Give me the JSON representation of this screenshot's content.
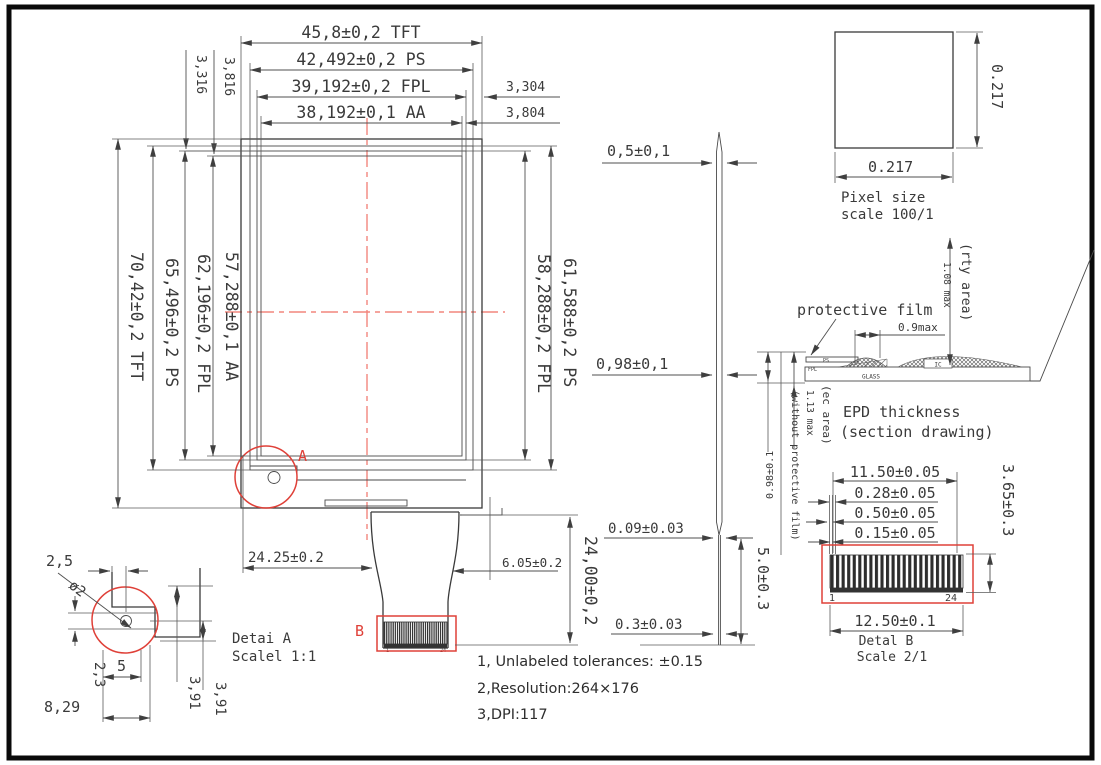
{
  "colors": {
    "line": "#3a3a3a",
    "dim_line": "#4f4f4f",
    "accent_red": "#df4038",
    "centerline_red": "#f2857d"
  },
  "front_view": {
    "top_dims": {
      "tft": "45,8±0,2 TFT",
      "ps": "42,492±0,2 PS",
      "fpl": "39,192±0,2 FPL",
      "aa": "38,192±0,1 AA",
      "right_offset_fpl": "3,304",
      "right_offset_aa": "3,804",
      "left_offset_fpl": "3,316",
      "left_offset_aa": "3,816"
    },
    "left_dims": {
      "tft": "70,42±0,2 TFT",
      "ps": "65,496±0,2 PS",
      "fpl": "62,196±0,2 FPL",
      "aa": "57,288±0,1 AA"
    },
    "right_dims": {
      "ps": "61,588±0,2 PS",
      "fpl": "58,288±0,2 FPL"
    },
    "bottom_dims": {
      "tail_offset": "24.25±0.2",
      "tail_side": "6.05±0.2",
      "tail_length": "24,00±0,2"
    },
    "detail_a_marker": "A",
    "detail_b_marker": "B"
  },
  "side_view": {
    "top": "0,5±0,1",
    "mid": "0,98±0,1",
    "fpc": "0.09±0.03",
    "stiffener": "5.0±0.3",
    "bottom": "0.3±0.03"
  },
  "pixel_view": {
    "width": "0.217",
    "height": "0.217",
    "caption1": "Pixel size",
    "caption2": "scale 100/1"
  },
  "section_view": {
    "film_label": "protective film",
    "dim_ic": "0.9max",
    "rty_area": "(rty area)",
    "rty_max": "1.08 max",
    "ec_area": "(ec area)",
    "ec_max": "1.13 max",
    "without_film": "(without protective film)",
    "without_dim": "0.98±0.1",
    "ps": "PS",
    "fpl": "FPL",
    "ic": "IC",
    "glass": "GLASS",
    "caption1": "EPD thickness",
    "caption2": "(section drawing)"
  },
  "detail_b": {
    "pitch_total": "11.50±0.05",
    "pin_width": "0.28±0.05",
    "pin_gap": "0.50±0.05",
    "pin_offset": "0.15±0.05",
    "height": "3.65±0.3",
    "total_width": "12.50±0.1",
    "pin_first": "1",
    "pin_last": "24",
    "caption1": "Detal B",
    "caption2": "Scale 2/1"
  },
  "detail_a": {
    "edge_to_hole": "2,5",
    "hole_dia": "ø2",
    "offset_v": "2,3",
    "width": "5",
    "h1": "3,91",
    "h2": "3,91",
    "base": "8,29",
    "caption1": "Detai A",
    "caption2": "Scalel 1:1"
  },
  "connector": {
    "pin_first": "1",
    "pin_last": "24"
  },
  "notes": {
    "line1": "1, Unlabeled tolerances: ±0.15",
    "line2": "2,Resolution:264×176",
    "line3": "3,DPI:117"
  }
}
